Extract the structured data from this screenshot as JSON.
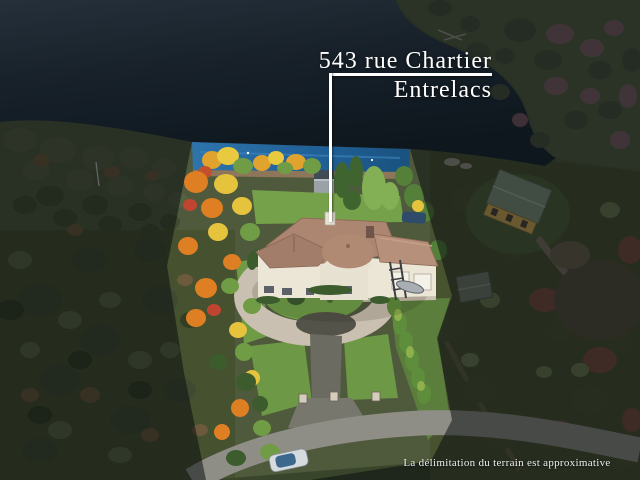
{
  "photo": {
    "address_line_1": "543 rue Chartier",
    "address_line_2": "Entrelacs",
    "disclaimer": "La délimitation du terrain est approximative"
  },
  "colors": {
    "label_text": "#ffffff",
    "pointer_line": "#ffffff",
    "lake_dark": "#16222e",
    "lake_highlighted": "#2166a0",
    "autumn_orange": "#df7f23",
    "autumn_yellow": "#e5c33d",
    "foliage_green": "#6f9c44",
    "house_roof": "#ac8671",
    "house_walls": "#ece6d7",
    "driveway_pavers": "#cac0b1",
    "asphalt": "#6b6b62",
    "dim_overlay": "rgba(7,11,16,0.52)"
  }
}
